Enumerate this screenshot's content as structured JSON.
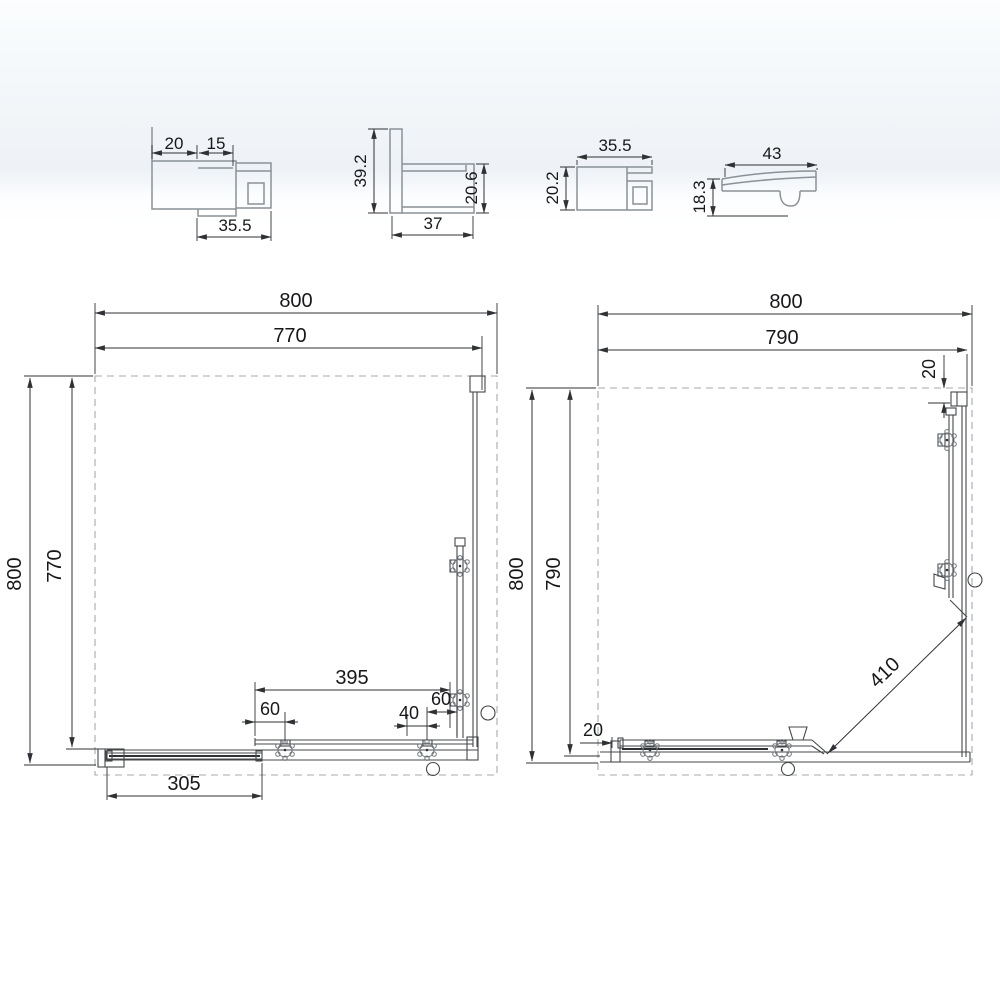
{
  "drawing": {
    "type": "shower-enclosure-technical-drawing",
    "colors": {
      "line": "#44474a",
      "profile_line": "#8a9197",
      "dimension": "#2f3134",
      "dashed": "#a4aab0",
      "background_band": "#eef2f6"
    },
    "profile1": {
      "dim_top_left": "20",
      "dim_top_right": "15",
      "dim_bottom": "35.5"
    },
    "profile2": {
      "dim_left": "39.2",
      "dim_right": "20.6",
      "dim_bottom": "37"
    },
    "profile3": {
      "dim_top": "35.5",
      "dim_left": "20.2"
    },
    "profile4": {
      "dim_top": "43",
      "dim_left": "18.3"
    },
    "plan_left": {
      "dim_width_outer": "800",
      "dim_width_inner": "770",
      "dim_height_outer": "800",
      "dim_height_inner": "770",
      "dim_fixed_panel": "395",
      "dim_roller_left": "60",
      "dim_roller_spacing": "40",
      "dim_roller_right": "60",
      "dim_door": "305"
    },
    "plan_right": {
      "dim_width_outer": "800",
      "dim_width_inner": "790",
      "dim_height_outer": "800",
      "dim_height_inner": "790",
      "dim_top_gap": "20",
      "dim_bottom_gap": "20",
      "dim_diagonal": "410"
    }
  }
}
